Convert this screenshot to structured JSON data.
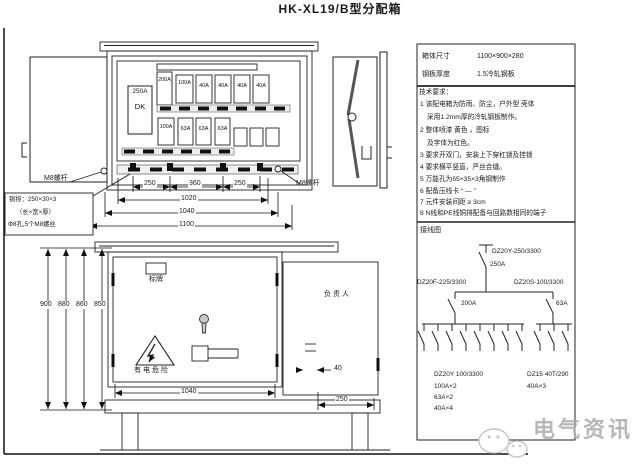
{
  "title": "HK-XL19/B型分配箱",
  "watermark": "电气资讯",
  "cabinet": {
    "main_switch_rating": "250A",
    "main_switch_label": "DK",
    "top_row_breakers": [
      "200A",
      "100A",
      "40A",
      "40A",
      "40A",
      "40A"
    ],
    "bottom_row_breakers": [
      "100A",
      "63A",
      "63A",
      "63A"
    ]
  },
  "top_view": {
    "bolt_label": "M8螺杆",
    "note_line1": "铜排：250×30×3",
    "note_line2": "（长×宽×厚）",
    "note_line3": "Φ8孔,5个M8螺丝",
    "dims": {
      "seg1": "250",
      "seg2": "360",
      "seg3": "250",
      "inner": "1020",
      "mid": "1040",
      "outer": "1100"
    }
  },
  "front_view": {
    "heights": [
      "900",
      "880",
      "860",
      "850"
    ],
    "nameplate": "标牌",
    "owner": "负责人",
    "warning": "有电危险",
    "width": "1040",
    "handle_gap": "40",
    "depth": "250"
  },
  "panel": {
    "specs": [
      {
        "label": "箱体尺寸",
        "value": "1100×900×280"
      },
      {
        "label": "钢板厚度",
        "value": "1.5冷轧钢板"
      }
    ],
    "tech_notes": {
      "title": "技术要求：",
      "lines": [
        "1 该配电箱为防雨、防尘，户外型 壳体",
        "采用1.2mm厚的冷轧钢板制作。",
        "2 整体喷漆 黄色 ，图标",
        "及字体为红色。",
        "3 要求开双门，安装上下穿杠锁及挂锁",
        "4 要求横平竖直，严丝合缝。",
        "5 万能孔为δ5×35×3角钢制作",
        "6 配备压线卡 “ — ”",
        "7 元件安装间距 ≥ 3cm",
        "8 N线和PE线铜排配备与回路数相同的端子"
      ]
    },
    "wiring": {
      "title": "接线图",
      "main_model": "DZ20Y-250/3300",
      "main_rating": "250A",
      "left_model": "DZ20F-225/3300",
      "left_rating": "200A",
      "right_model": "DZ20S-100/3300",
      "right_rating": "63A",
      "left_group_model": "DZ20Y 100/3300",
      "left_group_ratings": [
        "100A×2",
        "63A×2",
        "40A×4"
      ],
      "right_group_model": "DZ15 40T/290",
      "right_group_rating": "40A×3"
    }
  },
  "colors": {
    "line": "#222222",
    "watermark": "#ababab"
  }
}
